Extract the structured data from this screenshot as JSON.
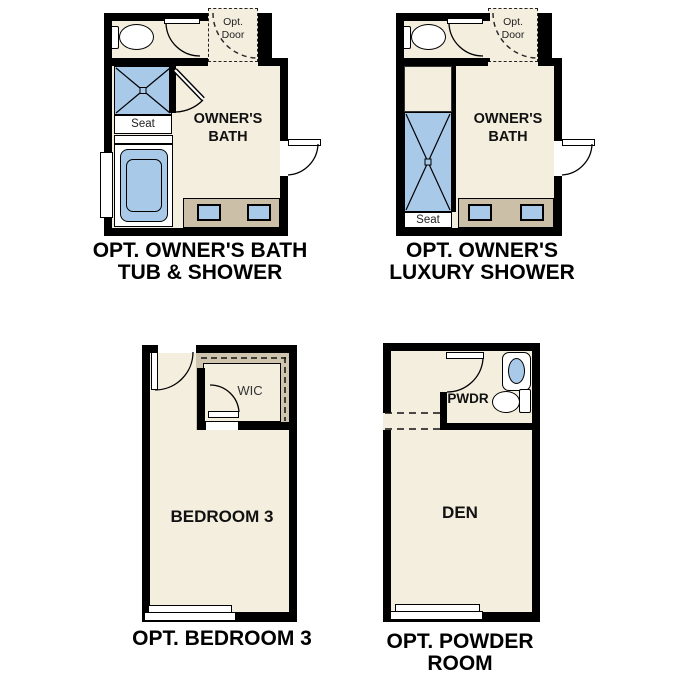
{
  "colors": {
    "wall": "#000000",
    "floor": "#f4eedf",
    "fixture_blue": "#a9c9e9",
    "vanity_tan": "#cbbfa8",
    "wic_tan": "#cfc4ae",
    "background": "#ffffff"
  },
  "plans": {
    "tub_shower": {
      "caption_line1": "OPT. OWNER'S BATH",
      "caption_line2": "TUB & SHOWER",
      "room_label_line1": "OWNER'S",
      "room_label_line2": "BATH",
      "seat_label": "Seat",
      "opt_door_line1": "Opt.",
      "opt_door_line2": "Door"
    },
    "luxury_shower": {
      "caption_line1": "OPT. OWNER'S",
      "caption_line2": "LUXURY SHOWER",
      "room_label_line1": "OWNER'S",
      "room_label_line2": "BATH",
      "seat_label": "Seat",
      "opt_door_line1": "Opt.",
      "opt_door_line2": "Door"
    },
    "bedroom3": {
      "caption": "OPT. BEDROOM 3",
      "room_label": "BEDROOM 3",
      "wic_label": "WIC"
    },
    "powder": {
      "caption_line1": "OPT. POWDER",
      "caption_line2": "ROOM",
      "room_label": "DEN",
      "pwdr_label": "PWDR"
    }
  }
}
